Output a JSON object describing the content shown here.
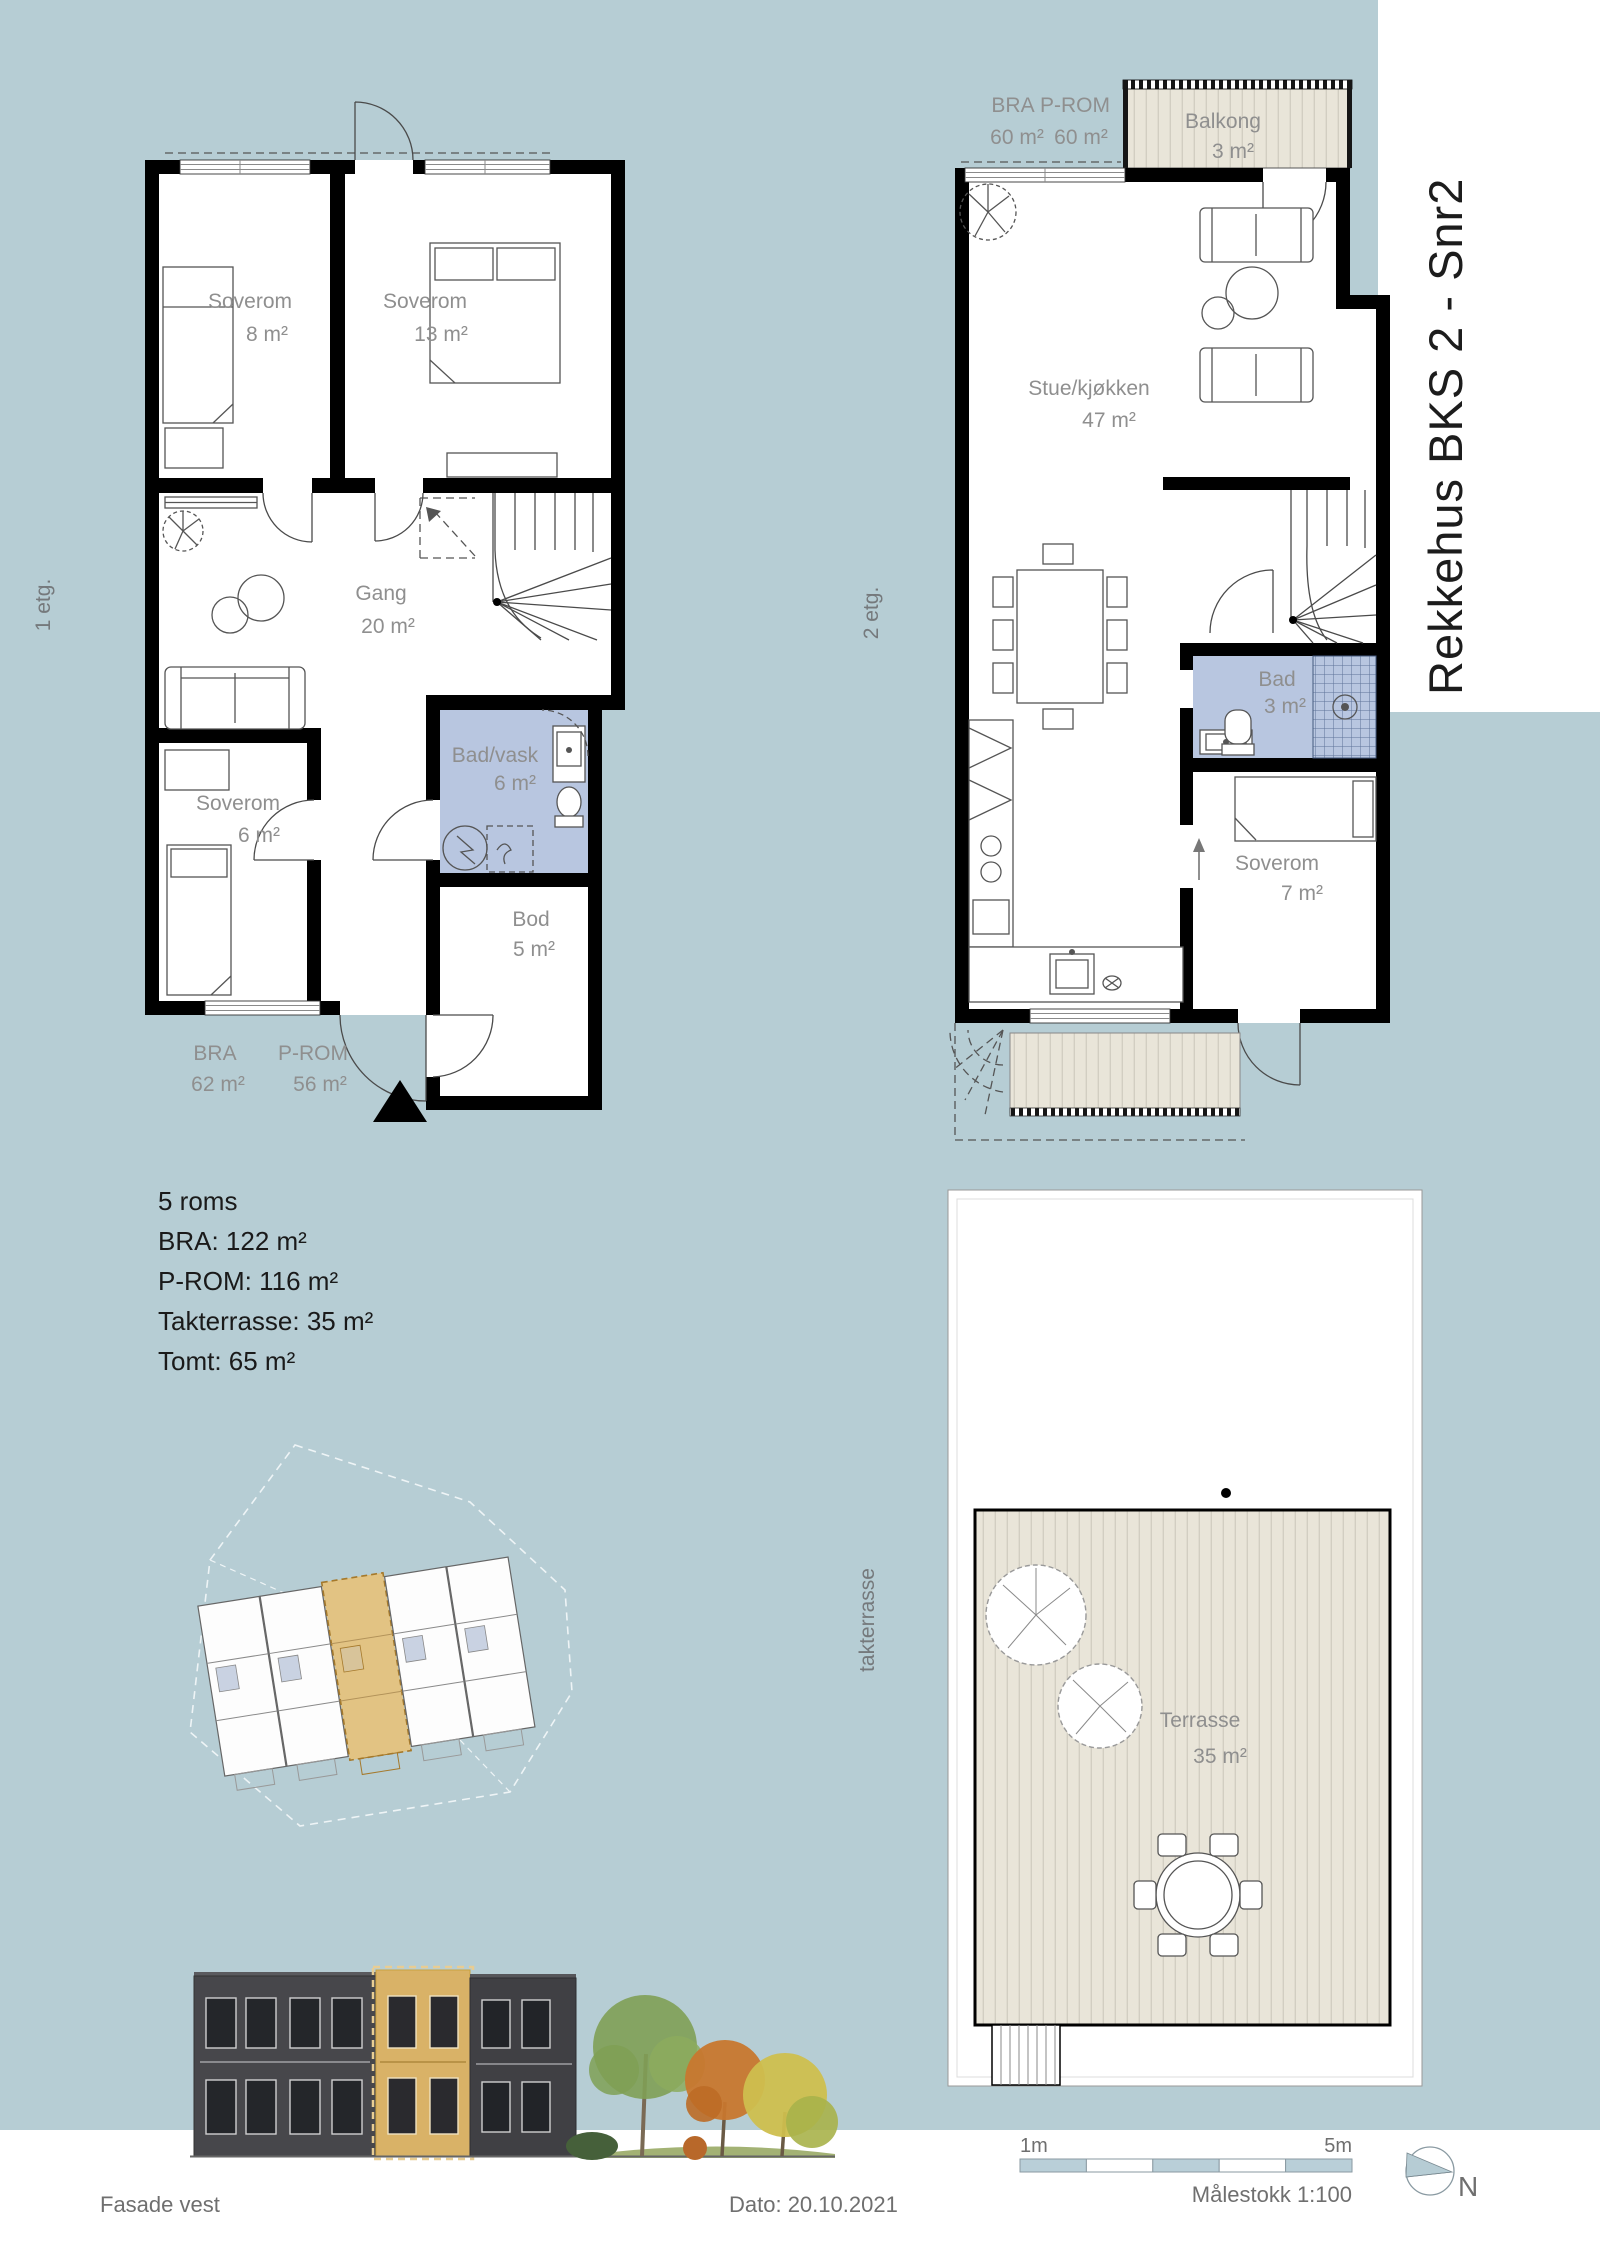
{
  "title": "Rekkehus BKS 2 - Snr2",
  "floor1": {
    "label": "1 etg.",
    "area_header": {
      "bra_label": "BRA",
      "bra_value": "62 m²",
      "prom_label": "P-ROM",
      "prom_value": "56 m²"
    },
    "rooms": {
      "soverom1": {
        "name": "Soverom",
        "area": "8 m²"
      },
      "soverom2": {
        "name": "Soverom",
        "area": "13 m²"
      },
      "gang": {
        "name": "Gang",
        "area": "20 m²"
      },
      "soverom3": {
        "name": "Soverom",
        "area": "6 m²"
      },
      "badvask": {
        "name": "Bad/vask",
        "area": "6 m²"
      },
      "bod": {
        "name": "Bod",
        "area": "5 m²"
      }
    }
  },
  "floor2": {
    "label": "2 etg.",
    "area_header": {
      "bra_label": "BRA",
      "bra_value": "60 m²",
      "prom_label": "P-ROM",
      "prom_value": "60 m²"
    },
    "rooms": {
      "balkong": {
        "name": "Balkong",
        "area": "3 m²"
      },
      "stue": {
        "name": "Stue/kjøkken",
        "area": "47 m²"
      },
      "bad": {
        "name": "Bad",
        "area": "3 m²"
      },
      "soverom": {
        "name": "Soverom",
        "area": "7 m²"
      }
    }
  },
  "roof": {
    "label": "takterrasse",
    "terrasse": {
      "name": "Terrasse",
      "area": "35 m²"
    }
  },
  "summary": {
    "line1": "5 roms",
    "line2": "BRA: 122 m²",
    "line3": "P-ROM: 116 m²",
    "line4": "Takterrasse: 35 m²",
    "line5": "Tomt: 65 m²"
  },
  "footer": {
    "facade": "Fasade vest",
    "date": "Dato: 20.10.2021",
    "scale": "Målestokk 1:100",
    "scale_start": "1m",
    "scale_end": "5m",
    "north": "N"
  },
  "colors": {
    "background": "#b6cdd4",
    "bathroom_floor": "#b8c6e0",
    "deck": "#e9e5d9",
    "room_label": "#8f8f8f",
    "dark_text": "#1a1a1a",
    "highlight_unit": "#e2c383",
    "facade_dark": "#47474b"
  }
}
